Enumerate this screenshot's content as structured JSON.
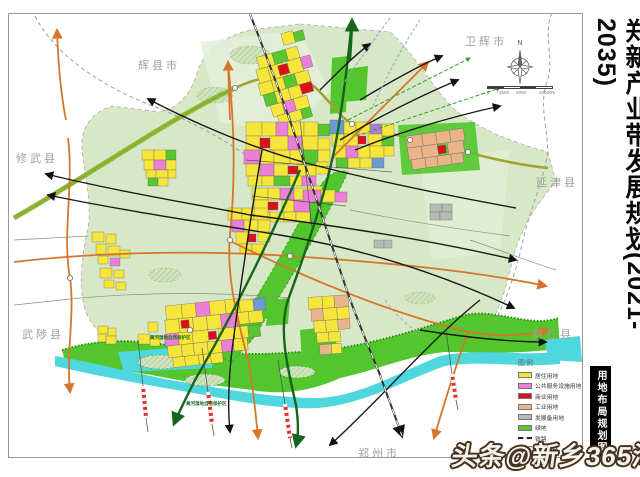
{
  "poster": {
    "title": "郑新产业带发展规划(2021-2035)",
    "subtitle": "用地布局规划图"
  },
  "watermark": "头条@新乡365淘房",
  "map": {
    "compass_north": "N",
    "scale_labels": [
      {
        "text": "0",
        "left": 0
      },
      {
        "text": "2500",
        "left": 12
      },
      {
        "text": "5000",
        "left": 29
      },
      {
        "text": "10000m",
        "left": 52
      }
    ],
    "region_labels": [
      {
        "id": "huixian",
        "text": "辉县市",
        "x": 130,
        "y": 44
      },
      {
        "id": "weihui",
        "text": "卫辉市",
        "x": 457,
        "y": 20
      },
      {
        "id": "xiuwu",
        "text": "修武县",
        "x": 8,
        "y": 137
      },
      {
        "id": "yanjin",
        "text": "延津县",
        "x": 528,
        "y": 161
      },
      {
        "id": "wuzhi",
        "text": "武陟县",
        "x": 14,
        "y": 313
      },
      {
        "id": "fengqiu",
        "text": "封丘县",
        "x": 524,
        "y": 313
      },
      {
        "id": "zhengzhou",
        "text": "郑州市",
        "x": 350,
        "y": 432
      }
    ],
    "annotations": [
      {
        "id": "wetland-1",
        "text": "黄河湿地自然保护区",
        "x": 142,
        "y": 322
      },
      {
        "id": "wetland-2",
        "text": "黄河湿地自然保护区",
        "x": 178,
        "y": 388
      }
    ]
  },
  "legend": {
    "title": "图例",
    "items": [
      {
        "label": "居住用地",
        "swatch": "fill",
        "color": "#f6e53a"
      },
      {
        "label": "公共服务设施用地",
        "swatch": "fill",
        "color": "#eb7fd7"
      },
      {
        "label": "商业用地",
        "swatch": "fill",
        "color": "#db1118"
      },
      {
        "label": "工业用地",
        "swatch": "fill",
        "color": "#e9b489"
      },
      {
        "label": "发展备用地",
        "swatch": "fill",
        "color": "#b7bbb7"
      },
      {
        "label": "绿地",
        "swatch": "fill",
        "color": "#58c631"
      },
      {
        "label": "铁路",
        "swatch": "dashed-line",
        "color": "#222222"
      },
      {
        "label": "高速公路",
        "swatch": "double-line",
        "color": "#d4762c"
      }
    ]
  },
  "colors": {
    "planning_area": "#d8e8c6",
    "greenbelt": "#52c62c",
    "river": "#4ed7de",
    "expressway": "#d4762c",
    "major_road_olive": "#a0a42f",
    "dark_green_road": "#15651c",
    "boundary_dash": "#9aa0a6"
  }
}
